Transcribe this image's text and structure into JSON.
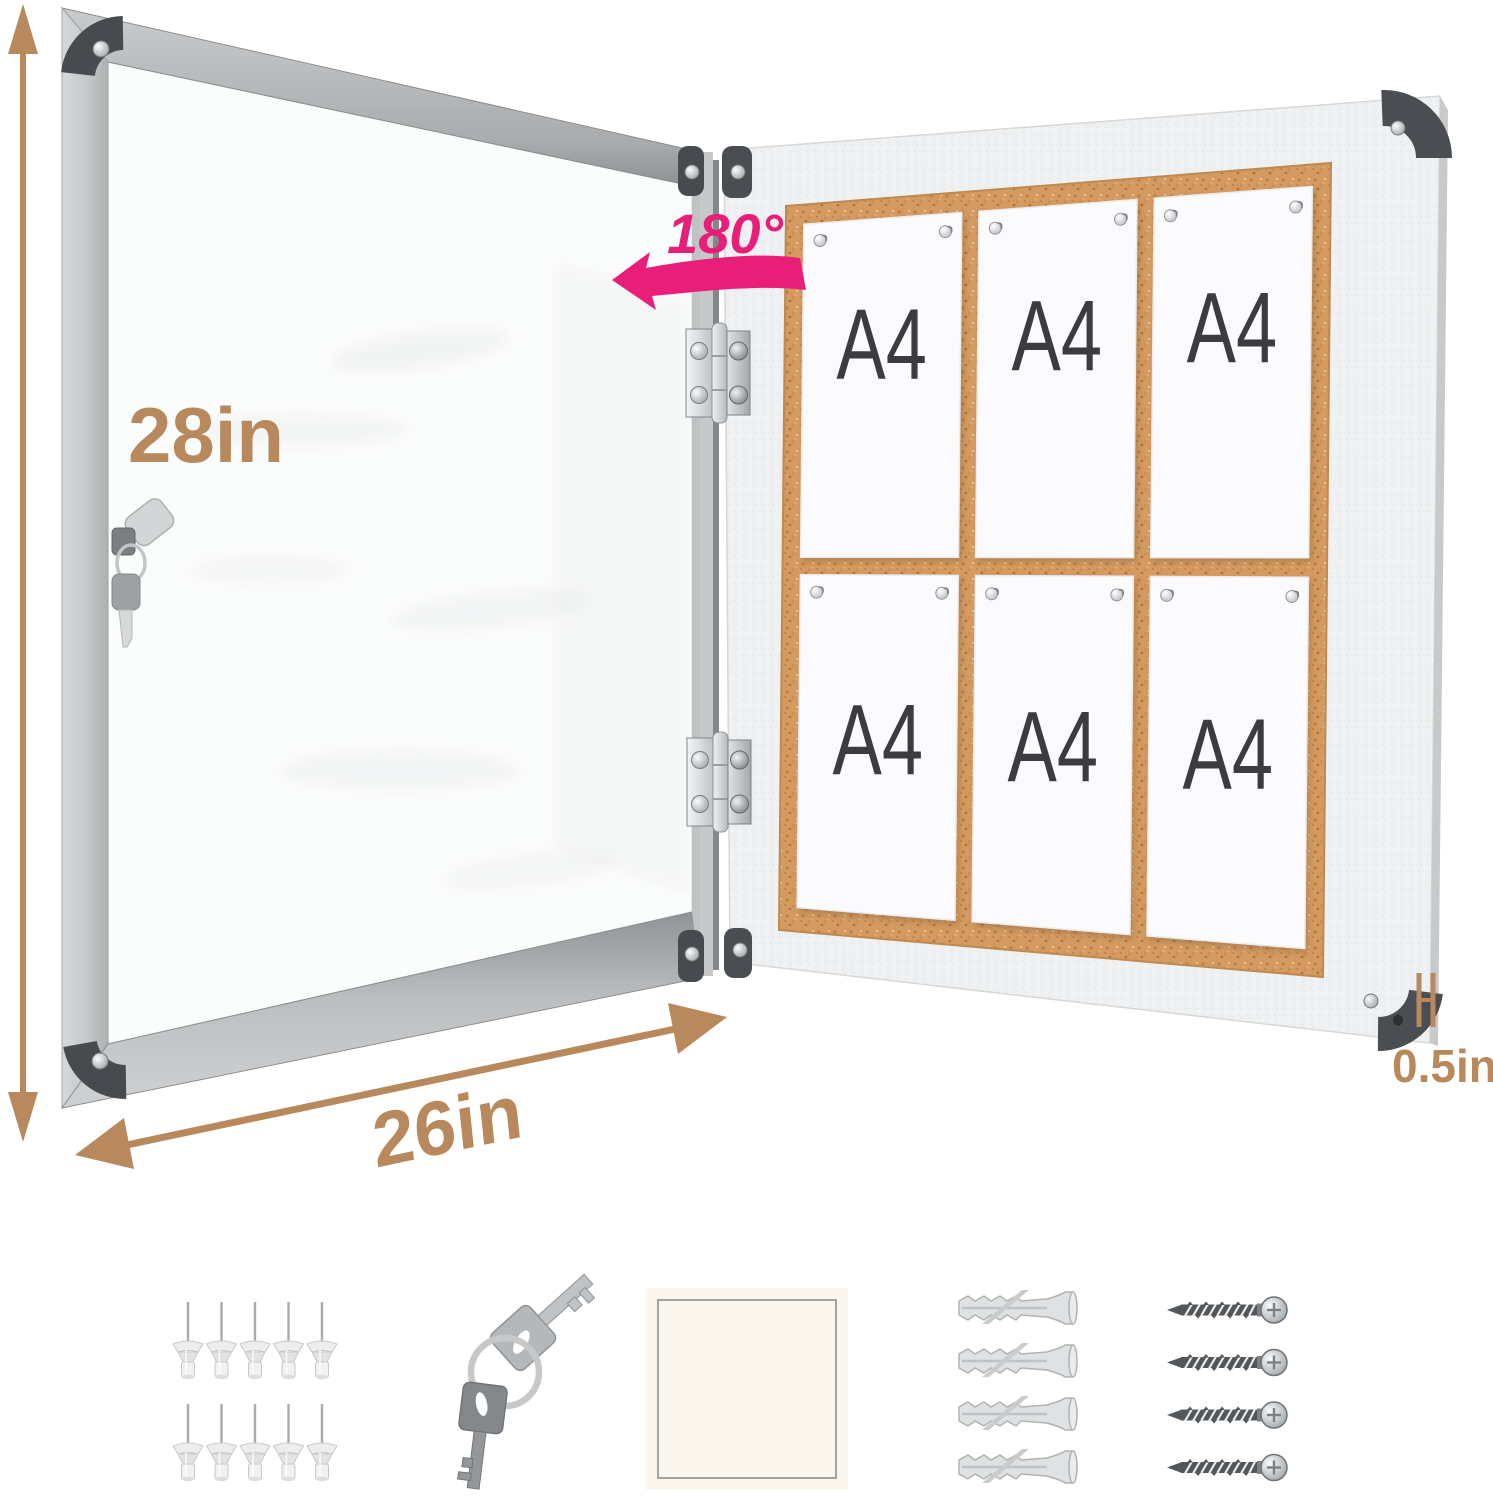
{
  "annotations": {
    "rotation": "180°",
    "height": "28in",
    "width": "26in",
    "depth": "0.5in"
  },
  "board": {
    "papers": [
      "A4",
      "A4",
      "A4",
      "A4",
      "A4",
      "A4"
    ]
  },
  "accessories": {
    "push_pin_count": 10,
    "key_count": 2,
    "wall_anchor_count": 4,
    "screw_count": 4,
    "card_count": 1
  },
  "colors": {
    "dimension_accent": "#b8895c",
    "rotation_accent": "#e81e78",
    "cork": "#d49a60"
  },
  "icons": {
    "push_pin": "push-pin-icon",
    "keys": "keys-icon",
    "blank_card": "blank-card-icon",
    "wall_anchor": "wall-anchor-icon",
    "screw": "screw-icon",
    "hinge": "hinge-icon",
    "lock": "lock-icon"
  }
}
